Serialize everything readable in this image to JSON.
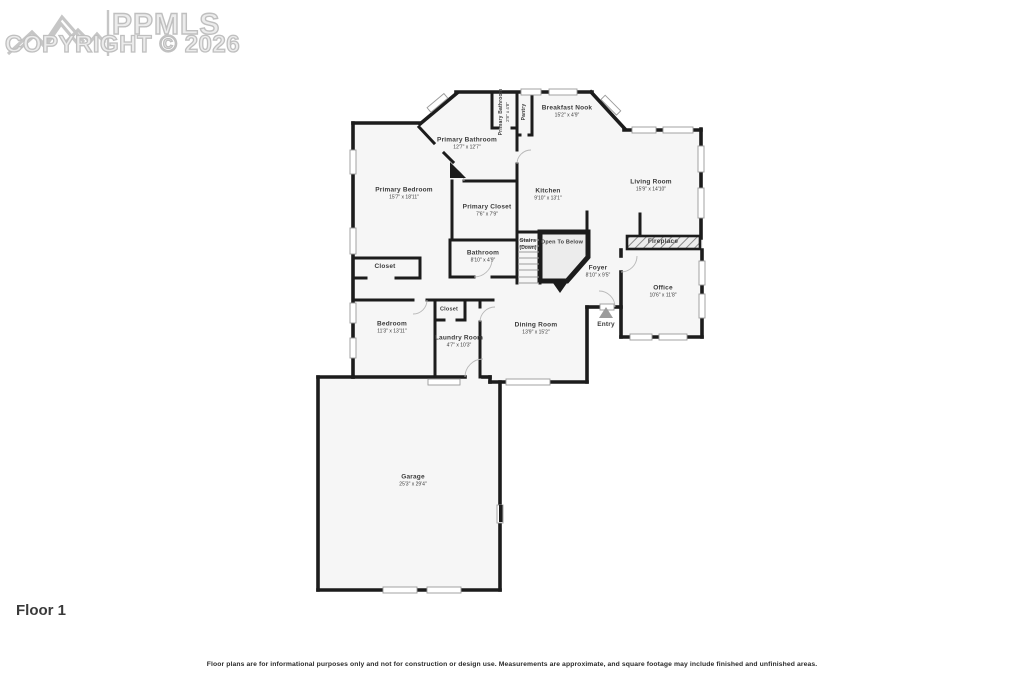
{
  "watermark": {
    "brand": "PPMLS",
    "copyright": "COPYRIGHT © 2026",
    "logo_icon": "mountain-logo-icon"
  },
  "floor_label": "Floor 1",
  "disclaimer": "Floor plans are for informational purposes only and not for construction or design use. Measurements are approximate, and square footage may include finished and unfinished areas.",
  "rooms": [
    {
      "id": "primary-bedroom",
      "name": "Primary Bedroom",
      "dims": "15'7\" x 18'11\""
    },
    {
      "id": "primary-bathroom",
      "name": "Primary Bathroom",
      "dims": "12'7\" x 12'7\""
    },
    {
      "id": "primary-bathroom-wc",
      "name": "Primary Bathroom",
      "dims": "2'8\" x 4'8\""
    },
    {
      "id": "pantry",
      "name": "Pantry",
      "dims": ""
    },
    {
      "id": "breakfast-nook",
      "name": "Breakfast Nook",
      "dims": "15'2\" x 4'9\""
    },
    {
      "id": "kitchen",
      "name": "Kitchen",
      "dims": "9'10\" x 13'1\""
    },
    {
      "id": "living-room",
      "name": "Living Room",
      "dims": "15'9\" x 14'10\""
    },
    {
      "id": "primary-closet",
      "name": "Primary Closet",
      "dims": "7'6\" x 7'9\""
    },
    {
      "id": "stairs",
      "name": "Stairs",
      "dims": "(Down)"
    },
    {
      "id": "open-to-below",
      "name": "Open To Below",
      "dims": ""
    },
    {
      "id": "fireplace",
      "name": "Fireplace",
      "dims": ""
    },
    {
      "id": "bathroom",
      "name": "Bathroom",
      "dims": "8'10\" x 4'9\""
    },
    {
      "id": "foyer",
      "name": "Foyer",
      "dims": "8'10\" x 9'5\""
    },
    {
      "id": "office",
      "name": "Office",
      "dims": "10'6\" x 11'8\""
    },
    {
      "id": "closet-hall",
      "name": "Closet",
      "dims": ""
    },
    {
      "id": "closet-bedroom",
      "name": "Closet",
      "dims": ""
    },
    {
      "id": "bedroom",
      "name": "Bedroom",
      "dims": "11'3\" x 13'11\""
    },
    {
      "id": "laundry-room",
      "name": "Laundry Room",
      "dims": "4'7\" x 10'3\""
    },
    {
      "id": "dining-room",
      "name": "Dining Room",
      "dims": "13'9\" x 15'2\""
    },
    {
      "id": "entry",
      "name": "Entry",
      "dims": ""
    },
    {
      "id": "garage",
      "name": "Garage",
      "dims": "25'3\" x 29'4\""
    }
  ],
  "colors": {
    "wall": "#1c1c1c",
    "floor": "#f6f6f6",
    "watermark": "#c4c4c4",
    "label_text": "#3b3b3b"
  }
}
